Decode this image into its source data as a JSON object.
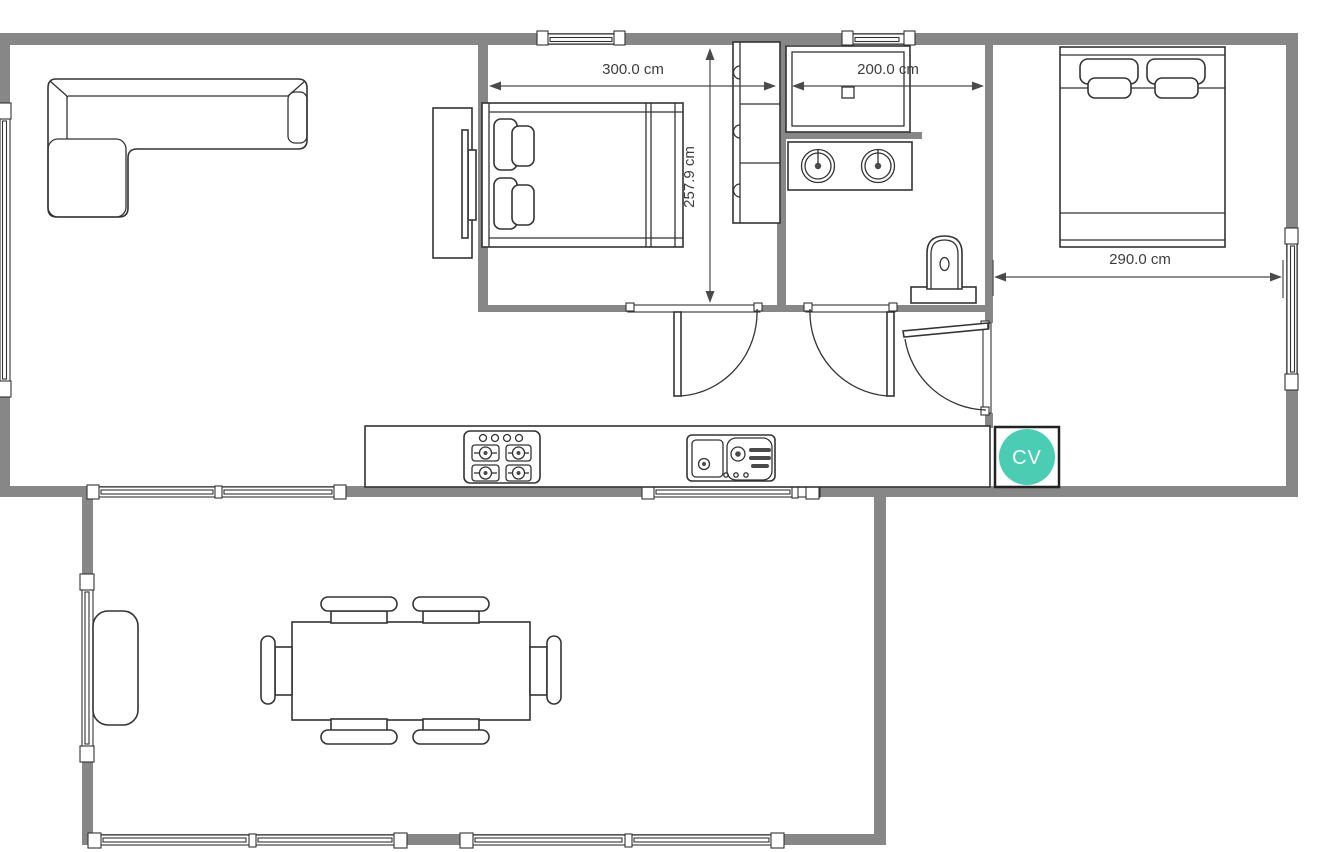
{
  "plan": {
    "type": "floor-plan",
    "units": "cm"
  },
  "dimensions": {
    "bedroom1_width": {
      "label": "300.0 cm"
    },
    "bathroom_width": {
      "label": "200.0 cm"
    },
    "bedroom1_depth": {
      "label": "257.9 cm"
    },
    "bedroom2_width": {
      "label": "290.0 cm"
    }
  },
  "badge": {
    "label": "CV",
    "color": "#4BCDB4"
  },
  "colors": {
    "wall": "#878787",
    "outline": "#333333",
    "dimension_text": "#3d3d3d",
    "background": "#ffffff"
  },
  "furniture_icons": [
    "corner-sofa-icon",
    "tv-console-icon",
    "double-bed-icon",
    "wardrobe-cabinet-icon",
    "shower-icon",
    "double-sink-vanity-icon",
    "toilet-icon",
    "second-double-bed-icon",
    "kitchen-counter-icon",
    "stove-icon",
    "kitchen-sink-icon",
    "dining-table-icon",
    "dining-chair-icon",
    "side-cabinet-icon",
    "door-icon",
    "window-icon"
  ]
}
